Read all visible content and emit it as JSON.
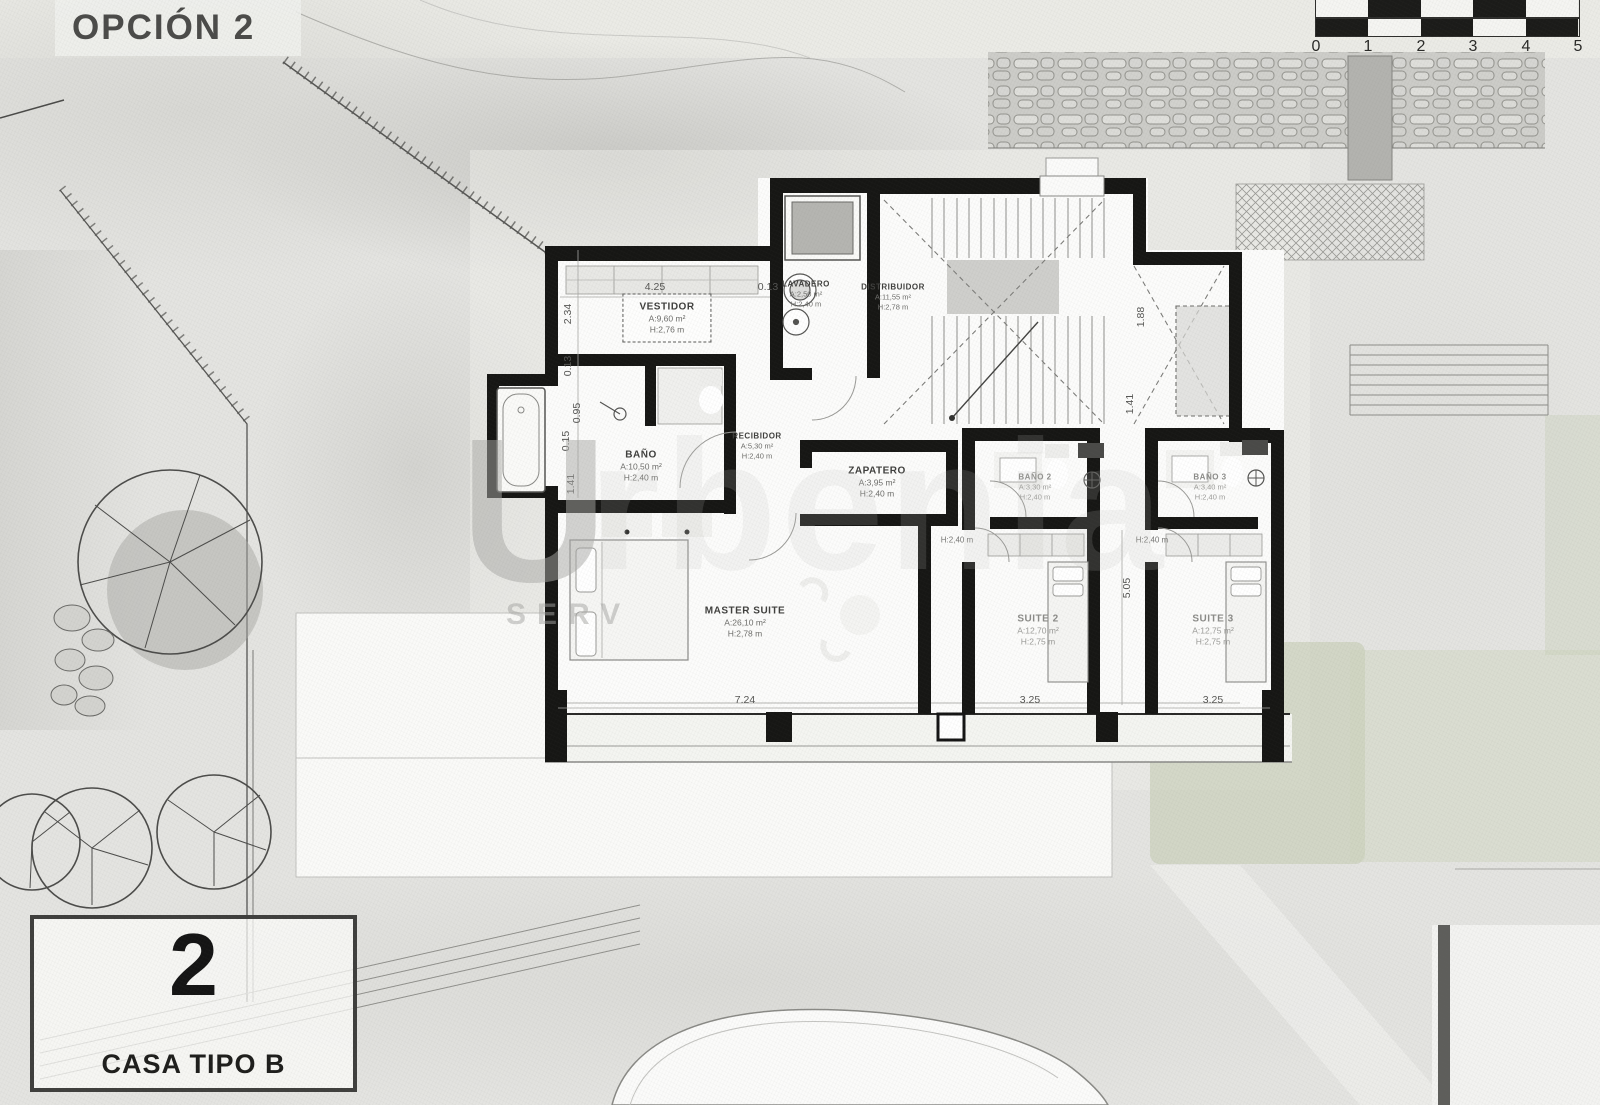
{
  "title": "OPCIÓN 2",
  "plan": {
    "rooms": [
      {
        "name": "VESTIDOR",
        "area": "A:9,60 m²",
        "height": "H:2,76 m"
      },
      {
        "name": "LAVADERO",
        "area": "A:2,50 m²",
        "height": "H:2,40 m"
      },
      {
        "name": "DISTRIBUIDOR",
        "area": "A:11,55 m²",
        "height": "H:2,78 m"
      },
      {
        "name": "BAÑO",
        "area": "A:10,50 m²",
        "height": "H:2,40 m"
      },
      {
        "name": "RECIBIDOR",
        "area": "A:5,30 m²",
        "height": "H:2,40 m"
      },
      {
        "name": "ZAPATERO",
        "area": "A:3,95 m²",
        "height": "H:2,40 m"
      },
      {
        "name": "BAÑO 2",
        "area": "A:3,30 m²",
        "height": "H:2,40 m"
      },
      {
        "name": "BAÑO 3",
        "area": "A:3,40 m²",
        "height": "H:2,40 m"
      },
      {
        "name": "MASTER SUITE",
        "area": "A:26,10 m²",
        "height": "H:2,78 m"
      },
      {
        "name": "SUITE 2",
        "area": "A:12,70 m²",
        "height": "H:2,75 m"
      },
      {
        "name": "SUITE 3",
        "area": "A:12,75 m²",
        "height": "H:2,75 m"
      }
    ],
    "dimensions": {
      "top_4_25": "4.25",
      "top_0_13": "0.13",
      "left_2_34": "2.34",
      "left_0_13": "0.13",
      "left_0_95": "0.95",
      "left_0_15": "0.15",
      "left_1_41": "1.41",
      "right_1_88": "1.88",
      "right_1_41": "1.41",
      "right_5_05": "5.05",
      "bottom_7_24": "7.24",
      "bottom_3_25_a": "3.25",
      "bottom_3_25_b": "3.25",
      "corridor_h_a": "H:2,40 m",
      "corridor_h_b": "H:2,40 m"
    }
  },
  "scale_bar": {
    "ticks": [
      "0",
      "1",
      "2",
      "3",
      "4",
      "5"
    ]
  },
  "info_box": {
    "number": "2",
    "label": "CASA TIPO B"
  },
  "watermark": {
    "initial": "U",
    "rest": "rbenia",
    "sub": "SERV"
  },
  "colors": {
    "wall": "#161614",
    "paper": "#e4e4e1",
    "green": "#c6cdb4",
    "stone": "#d6d6d2"
  }
}
